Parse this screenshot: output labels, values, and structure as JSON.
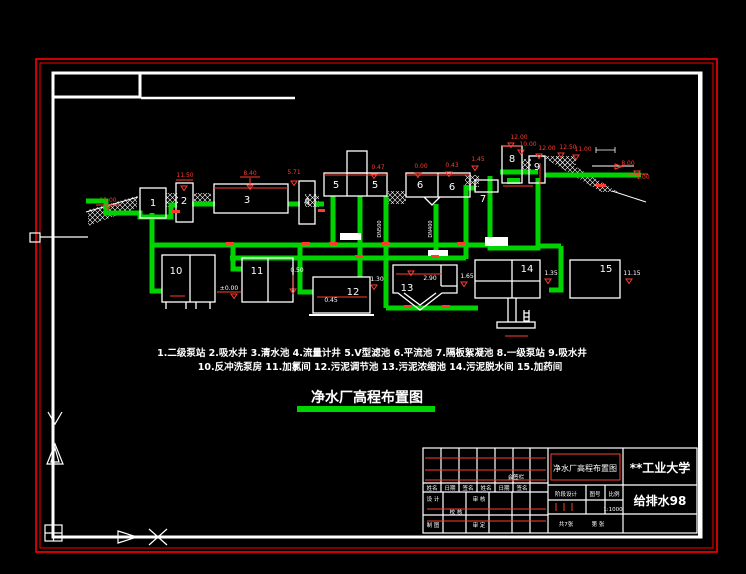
{
  "canvas": {
    "background": "#000000",
    "border_color": "#ff0000",
    "frame_color": "#ffffff",
    "pipe_color": "#00d400"
  },
  "legend": {
    "line1": "1.二级泵站 2.吸水井 3.清水池 4.流量计井 5.V型滤池 6.平流池 7.隔板絮凝池 8.一级泵站 9.吸水井",
    "line2": "10.反冲洗泵房 11.加氯间 12.污泥调节池 13.污泥浓缩池 14.污泥脱水间 15.加药间"
  },
  "title": {
    "text": "净水厂高程布置图"
  },
  "structures": {
    "labels": [
      "1",
      "2",
      "3",
      "4",
      "5",
      "5",
      "6",
      "6",
      "7",
      "8",
      "9",
      "10",
      "11",
      "12",
      "13",
      "14",
      "15"
    ]
  },
  "elevations": {
    "values": [
      "15.00",
      "11.50",
      "8.40",
      "5.71",
      "0.47",
      "0.00",
      "0.43",
      "1.45",
      "12.00",
      "10.00",
      "12.00",
      "12.50",
      "11.00",
      "8.00",
      "1.00",
      "±0.00",
      "0.50",
      "0.45",
      "1.30",
      "2.90",
      "1.65",
      "1.35",
      "11.15"
    ]
  },
  "pipe_labels": [
    "DN500",
    "DN400"
  ],
  "title_block": {
    "drawing_title": "净水厂高程布置图",
    "school": "**工业大学",
    "class": "给排水98",
    "stage": "阶段设计",
    "sheet_label": "图号",
    "scale_label": "比例",
    "scale_value": "1:1000",
    "sheet_total": "共7张",
    "sheet_number": "第 张",
    "countersign": "会签栏",
    "sign_header": [
      "姓名",
      "日期",
      "签名",
      "姓名",
      "日期",
      "签名"
    ],
    "fields": {
      "design": "设 计",
      "draft": "制 图",
      "check": "校 核",
      "review": "审 核",
      "approve": "审 定"
    }
  }
}
